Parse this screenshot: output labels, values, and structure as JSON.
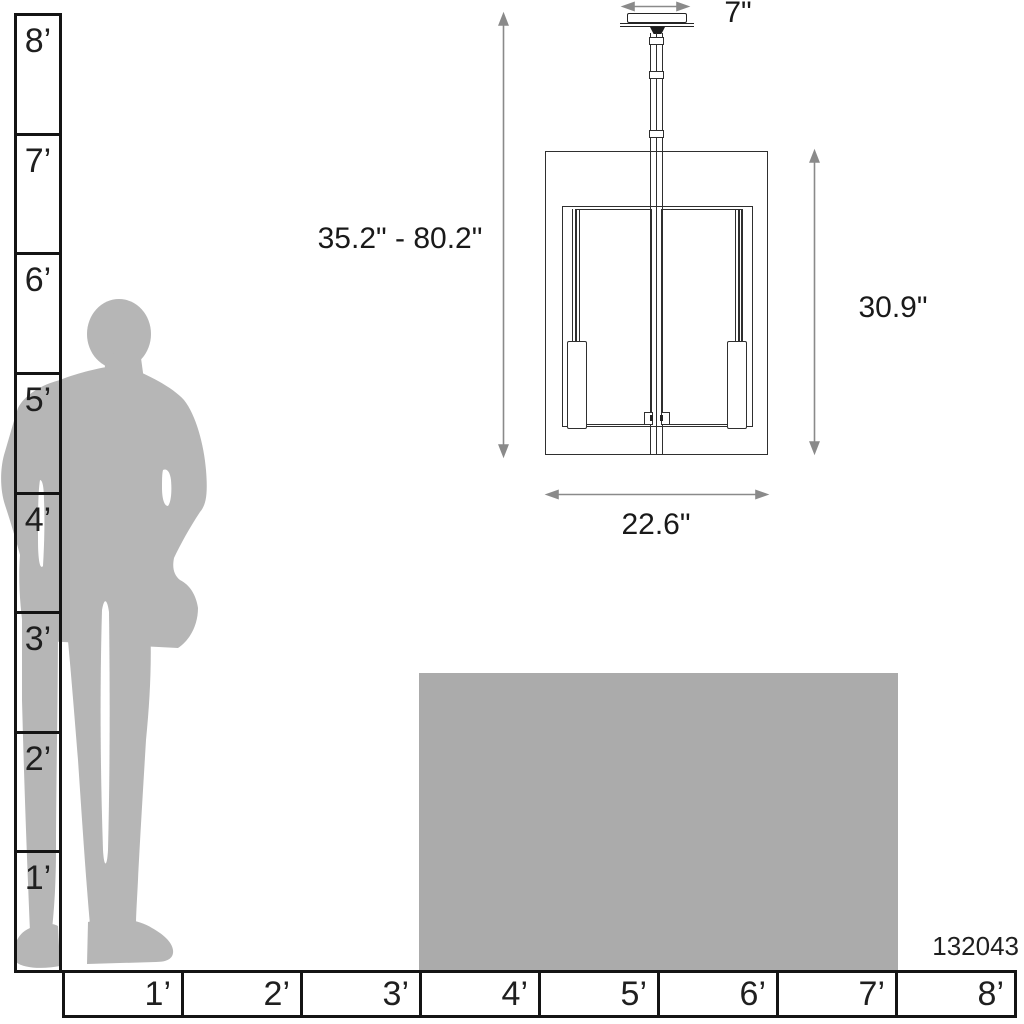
{
  "figure": {
    "type": "pendant-light-dimension-diagram",
    "product_number": "132043",
    "dimensions": {
      "hanging_height_range": "35.2\" - 80.2\"",
      "fixture_height": "30.9\"",
      "fixture_width": "22.6\"",
      "canopy_width": "7\""
    }
  },
  "rulers": {
    "unit": "feet",
    "vertical_labels": [
      "8’",
      "7’",
      "6’",
      "5’",
      "4’",
      "3’",
      "2’",
      "1’"
    ],
    "horizontal_labels": [
      "1’",
      "2’",
      "3’",
      "4’",
      "5’",
      "6’",
      "7’",
      "8’"
    ]
  },
  "colors": {
    "silhouette_gray": "#b6b6b6",
    "table_gray": "#ababab",
    "ruler_line": "#141414",
    "drawing_line": "#2f2f2f",
    "arrow_gray": "#8a8a8a",
    "background": "#ffffff"
  }
}
